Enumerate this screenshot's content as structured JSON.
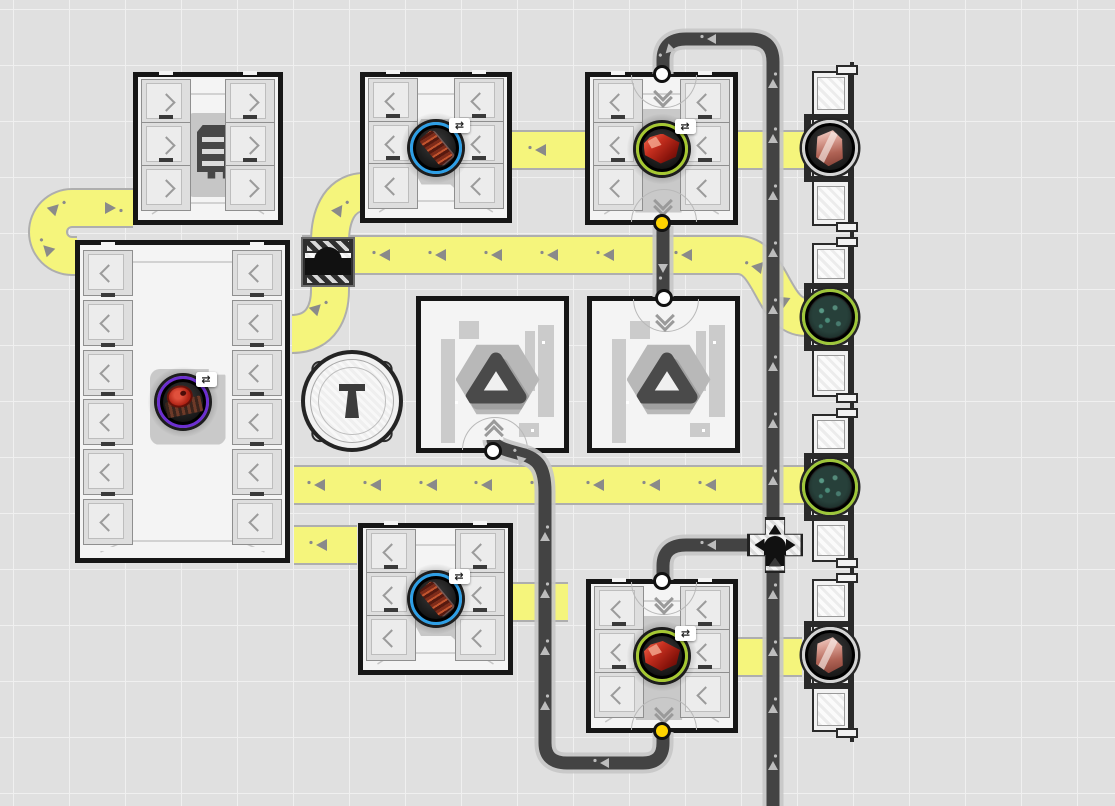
{
  "scene": {
    "name": "factory-grid-view",
    "width": 1115,
    "height": 806
  },
  "palette": {
    "bg": "#e0e0e0",
    "grid_line": "#f0f0f0",
    "belt_fill": "#f5f57c",
    "belt_edge": "#aeaeae",
    "belt_arrow": "#8a8a8a",
    "road_fill": "#434343",
    "road_edge": "#c7c7c7",
    "road_arrow": "#bdbdbd",
    "frame": "#161616",
    "building_fill": "#f4f4f4",
    "slot_fill": "#dedede",
    "slot_edge": "#8f8f8f",
    "chevron": "#9b9b9b",
    "silhouette": "#c7c7c7",
    "port_white": "#ffffff",
    "port_yellow": "#ffd400",
    "ring_blue": "#2e9fe6",
    "ring_green": "#a6c832",
    "ring_purple": "#6c2fd0",
    "ring_silver": "#d4d4d4",
    "item_bg": "#181818",
    "column_line": "#2a2a2a"
  },
  "icons": {
    "swap_badge": "⇄"
  },
  "grid": {
    "cell": 56,
    "offset_x": 13,
    "offset_y": 9
  },
  "belts": {
    "paths": [
      {
        "id": "belt-uturn-west",
        "d": "M133 208 L72 208 A24 24 0 1 0 72 256 L77 256"
      },
      {
        "id": "belt-bridge-vertical",
        "d": "M292 334 C322 334 330 310 330 290 L330 242 C330 218 338 194 362 192"
      },
      {
        "id": "belt-row-north",
        "d": "M302 255 L738 255 C772 255 772 317 806 317"
      },
      {
        "id": "belt-row-south",
        "d": "M294 485 L806 485"
      },
      {
        "id": "belt-stub-west",
        "d": "M294 545 L357 545"
      },
      {
        "id": "belt-stub-mid-north",
        "d": "M512 150 L586 150"
      },
      {
        "id": "belt-stub-east-north",
        "d": "M738 150 L806 150"
      },
      {
        "id": "belt-stub-mid-south",
        "d": "M513 602 L568 602"
      },
      {
        "id": "belt-stub-east-south",
        "d": "M738 657 L802 657"
      }
    ],
    "arrows": [
      [
        105,
        208,
        0
      ],
      [
        51,
        212,
        -45
      ],
      [
        51,
        253,
        -135
      ],
      [
        313,
        312,
        -45
      ],
      [
        336,
        214,
        -55
      ],
      [
        390,
        255,
        180
      ],
      [
        446,
        255,
        180
      ],
      [
        502,
        255,
        180
      ],
      [
        558,
        255,
        180
      ],
      [
        614,
        255,
        180
      ],
      [
        692,
        255,
        180
      ],
      [
        762,
        268,
        -170
      ],
      [
        787,
        303,
        -145
      ],
      [
        325,
        485,
        180
      ],
      [
        381,
        485,
        180
      ],
      [
        437,
        485,
        180
      ],
      [
        492,
        485,
        180
      ],
      [
        548,
        485,
        180
      ],
      [
        604,
        485,
        180
      ],
      [
        660,
        485,
        180
      ],
      [
        716,
        485,
        180
      ],
      [
        327,
        545,
        180
      ],
      [
        546,
        150,
        180
      ]
    ]
  },
  "roads": {
    "paths": [
      {
        "id": "road-main-east",
        "d": "M773 806 L773 62 Q773 39 750 39 L686 39 Q663 39 663 60 L663 74"
      },
      {
        "id": "road-junction-branch",
        "d": "M747 545 L686 545 Q663 545 663 566 L663 580"
      },
      {
        "id": "road-refinery-link",
        "d": "M663 226 L663 297"
      },
      {
        "id": "road-south-loop",
        "d": "M663 732 L663 743 Q663 763 643 763 L567 763 Q545 763 545 743 L545 492 C545 466 537 458 521 454 C505 450 493 446 493 440"
      }
    ],
    "arrows": [
      [
        773,
        88,
        -90
      ],
      [
        773,
        143,
        -90
      ],
      [
        773,
        200,
        -90
      ],
      [
        773,
        257,
        -90
      ],
      [
        773,
        314,
        -90
      ],
      [
        773,
        371,
        -90
      ],
      [
        773,
        428,
        -90
      ],
      [
        773,
        485,
        -90
      ],
      [
        773,
        599,
        -90
      ],
      [
        773,
        656,
        -90
      ],
      [
        773,
        713,
        -90
      ],
      [
        773,
        770,
        -90
      ],
      [
        716,
        39,
        180
      ],
      [
        672,
        47,
        135
      ],
      [
        716,
        545,
        180
      ],
      [
        663,
        264,
        90
      ],
      [
        609,
        763,
        180
      ],
      [
        545,
        710,
        -90
      ],
      [
        545,
        655,
        -90
      ],
      [
        545,
        598,
        -90
      ],
      [
        545,
        541,
        -90
      ],
      [
        523,
        462,
        -135
      ]
    ]
  },
  "buildings": [
    {
      "id": "storage-small-north",
      "kind": "storage",
      "x": 133,
      "y": 72,
      "w": 150,
      "h": 153,
      "slots": {
        "left": 3,
        "right": 3,
        "chevron": "right"
      },
      "silhouette": "shelf"
    },
    {
      "id": "assembler-north",
      "kind": "assembler",
      "x": 360,
      "y": 72,
      "w": 152,
      "h": 151,
      "slots": {
        "left": 3,
        "right": 3,
        "chevron": "left"
      },
      "silhouette": "wrench",
      "item": {
        "icon": "copper-component",
        "ring": "#2e9fe6",
        "badge": true
      }
    },
    {
      "id": "refinery-north",
      "kind": "refinery",
      "x": 585,
      "y": 72,
      "w": 153,
      "h": 153,
      "slots": {
        "left": 3,
        "right": 3,
        "chevron": "left"
      },
      "silhouette": "hopper",
      "item": {
        "icon": "red-ore",
        "ring": "#a6c832",
        "badge": true
      },
      "ports": [
        {
          "side": "top",
          "color": "white",
          "chevron": "down"
        },
        {
          "side": "bottom",
          "color": "yellow",
          "chevron": "down"
        }
      ]
    },
    {
      "id": "storage-large-west",
      "kind": "storage",
      "x": 75,
      "y": 240,
      "w": 215,
      "h": 323,
      "slots": {
        "left": 6,
        "right": 6,
        "chevron": "left"
      },
      "silhouette": "pad",
      "item": {
        "icon": "red-disc-part",
        "ring": "#6c2fd0",
        "badge": true
      }
    },
    {
      "id": "hub-west",
      "kind": "hub",
      "x": 416,
      "y": 296,
      "w": 153,
      "h": 157,
      "ports": [
        {
          "side": "bottom",
          "color": "white",
          "chevron": "up"
        }
      ]
    },
    {
      "id": "hub-east",
      "kind": "hub",
      "x": 587,
      "y": 296,
      "w": 153,
      "h": 157,
      "ports": [
        {
          "side": "top",
          "color": "white",
          "chevron": "down"
        }
      ]
    },
    {
      "id": "assembler-south",
      "kind": "assembler",
      "x": 358,
      "y": 523,
      "w": 155,
      "h": 152,
      "slots": {
        "left": 3,
        "right": 3,
        "chevron": "left"
      },
      "silhouette": "wrench",
      "item": {
        "icon": "copper-component",
        "ring": "#2e9fe6",
        "badge": true
      }
    },
    {
      "id": "refinery-south",
      "kind": "refinery",
      "x": 586,
      "y": 579,
      "w": 152,
      "h": 154,
      "slots": {
        "left": 3,
        "right": 3,
        "chevron": "left"
      },
      "silhouette": "hopper",
      "item": {
        "icon": "red-ore",
        "ring": "#a6c832",
        "badge": true
      },
      "ports": [
        {
          "side": "top",
          "color": "white",
          "chevron": "down"
        },
        {
          "side": "bottom",
          "color": "yellow",
          "chevron": "down"
        }
      ]
    }
  ],
  "tiles": {
    "bridge": {
      "id": "belt-bridge-tile",
      "x": 301,
      "y": 237,
      "w": 54,
      "h": 50
    },
    "junction": {
      "id": "road-junction-tile",
      "x": 747,
      "y": 517,
      "w": 56,
      "h": 56
    },
    "pillar": {
      "id": "pillar-tower",
      "cx": 352,
      "cy": 401,
      "r": 51
    }
  },
  "exchange_column": {
    "id": "exchange-column-east",
    "x": 812,
    "w": 38,
    "spine_x": 850,
    "spine_top": 62,
    "spine_bottom": 742,
    "sections": [
      {
        "y": 65,
        "h": 167,
        "port_y": 148,
        "item": "pink-crystal",
        "ring": "#d4d4d4"
      },
      {
        "y": 237,
        "h": 166,
        "port_y": 317,
        "item": "green-crystal",
        "ring": "#9ec63a"
      },
      {
        "y": 408,
        "h": 160,
        "port_y": 487,
        "item": "green-crystal",
        "ring": "#9ec63a"
      },
      {
        "y": 573,
        "h": 165,
        "port_y": 655,
        "item": "pink-crystal",
        "ring": "#d4d4d4"
      }
    ]
  }
}
